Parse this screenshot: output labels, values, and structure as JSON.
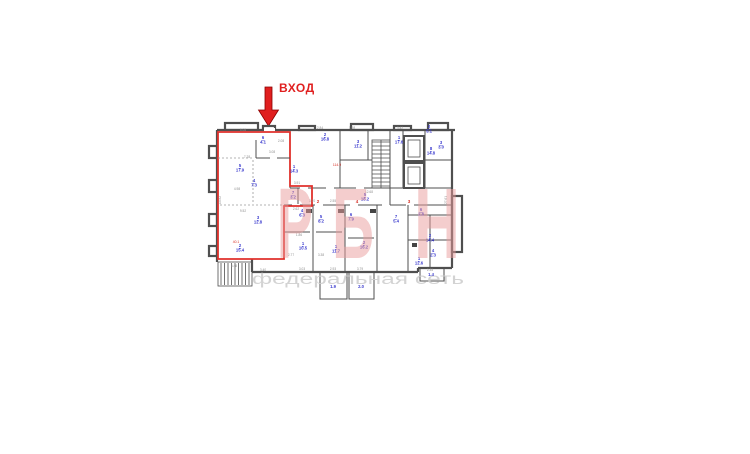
{
  "entrance": {
    "label": "ВХОД",
    "color": "#e01f1f"
  },
  "watermark": {
    "letters": [
      {
        "ch": "Р",
        "x": 277,
        "w": 36
      },
      {
        "ch": "Б",
        "x": 332,
        "w": 42
      },
      {
        "ch": "Н",
        "x": 414,
        "w": 46
      }
    ],
    "baseline": 258,
    "size": 100,
    "color": "#ea9c9c",
    "opacity": 0.5,
    "subtext": "федеральная сеть",
    "sub_x": 252,
    "sub_w": 212,
    "sub_y": 284,
    "sub_size": 15.5,
    "sub_color": "#cfcfcf"
  },
  "plan": {
    "colors": {
      "wall": "#4f4f4f",
      "unit_outline": "#e0312c",
      "room_label": "#3a3ace",
      "dimension": "#8f8f8f",
      "red_note": "#d93025"
    },
    "room_labels": [
      {
        "num": "6",
        "area": "4.1",
        "x": 263,
        "y": 139
      },
      {
        "num": "5",
        "area": "17.9",
        "x": 240,
        "y": 167
      },
      {
        "num": "4",
        "area": "7.3",
        "x": 254,
        "y": 182
      },
      {
        "num": "7",
        "area": "3.2",
        "x": 293,
        "y": 194
      },
      {
        "num": "3",
        "area": "12.8",
        "x": 258,
        "y": 219
      },
      {
        "num": "2",
        "area": "15.4",
        "x": 240,
        "y": 247
      },
      {
        "num": "2",
        "area": "16.8",
        "x": 325,
        "y": 136
      },
      {
        "num": "1",
        "area": "14.3",
        "x": 294,
        "y": 168
      },
      {
        "num": "3",
        "area": "11.2",
        "x": 358,
        "y": 143
      },
      {
        "num": "1",
        "area": "17.6",
        "x": 399,
        "y": 139
      },
      {
        "num": "2",
        "area": "5.1",
        "x": 429,
        "y": 128
      },
      {
        "num": "3",
        "area": "3.0",
        "x": 441,
        "y": 144
      },
      {
        "num": "8",
        "area": "14.8",
        "x": 431,
        "y": 150
      },
      {
        "num": "5",
        "area": "18.2",
        "x": 365,
        "y": 196
      },
      {
        "num": "4",
        "area": "6.3",
        "x": 302,
        "y": 212
      },
      {
        "num": "1",
        "area": "10.5",
        "x": 303,
        "y": 245
      },
      {
        "num": "5",
        "area": "8.2",
        "x": 321,
        "y": 218
      },
      {
        "num": "1",
        "area": "11.7",
        "x": 336,
        "y": 248
      },
      {
        "num": "6",
        "area": "7.9",
        "x": 351,
        "y": 216
      },
      {
        "num": "2",
        "area": "16.2",
        "x": 364,
        "y": 244
      },
      {
        "num": "7",
        "area": "5.4",
        "x": 396,
        "y": 218
      },
      {
        "num": "2",
        "area": "14.4",
        "x": 430,
        "y": 237
      },
      {
        "num": "6",
        "area": "2.8",
        "x": 421,
        "y": 211
      },
      {
        "num": "4",
        "area": "2.3",
        "x": 433,
        "y": 252
      },
      {
        "num": "1",
        "area": "12.6",
        "x": 419,
        "y": 260
      },
      {
        "num": "",
        "area": "1.9",
        "x": 333,
        "y": 288
      },
      {
        "num": "",
        "area": "2.0",
        "x": 361,
        "y": 288
      },
      {
        "num": "",
        "area": "1.4",
        "x": 431,
        "y": 276
      }
    ],
    "dimensions": [
      {
        "t": "5.08",
        "x": 243,
        "y": 131
      },
      {
        "t": "2.84",
        "x": 320,
        "y": 129
      },
      {
        "t": "1.98",
        "x": 352,
        "y": 129
      },
      {
        "t": "3.42",
        "x": 400,
        "y": 129
      },
      {
        "t": "2.08",
        "x": 281,
        "y": 142
      },
      {
        "t": "3.08",
        "x": 272,
        "y": 153
      },
      {
        "t": "7.28",
        "x": 247,
        "y": 158
      },
      {
        "t": "4.98",
        "x": 237,
        "y": 190
      },
      {
        "t": "3.91",
        "x": 297,
        "y": 184
      },
      {
        "t": "13.92",
        "x": 221,
        "y": 200,
        "r": -90
      },
      {
        "t": "9.52",
        "x": 243,
        "y": 212
      },
      {
        "t": "2.62",
        "x": 296,
        "y": 210
      },
      {
        "t": "12.68",
        "x": 369,
        "y": 193
      },
      {
        "t": "3.70",
        "x": 312,
        "y": 202
      },
      {
        "t": "2.55",
        "x": 333,
        "y": 202
      },
      {
        "t": "1.86",
        "x": 299,
        "y": 236
      },
      {
        "t": "2.77",
        "x": 291,
        "y": 256
      },
      {
        "t": "3.38",
        "x": 321,
        "y": 256
      },
      {
        "t": "3.40",
        "x": 263,
        "y": 271
      },
      {
        "t": "3.03",
        "x": 302,
        "y": 270
      },
      {
        "t": "2.93",
        "x": 333,
        "y": 270
      },
      {
        "t": "3.79",
        "x": 360,
        "y": 270
      },
      {
        "t": "27.61",
        "x": 447,
        "y": 200,
        "r": -90
      },
      {
        "t": "5.48",
        "x": 234,
        "y": 267
      },
      {
        "t": "2.35",
        "x": 430,
        "y": 271
      }
    ],
    "red_notes": [
      {
        "t": "114.9",
        "x": 337,
        "y": 166
      },
      {
        "t": "40.1",
        "x": 236,
        "y": 243
      }
    ],
    "apt_numbers": [
      {
        "t": "2",
        "x": 318,
        "y": 203
      },
      {
        "t": "4",
        "x": 357,
        "y": 203
      },
      {
        "t": "3",
        "x": 409,
        "y": 203
      }
    ]
  }
}
